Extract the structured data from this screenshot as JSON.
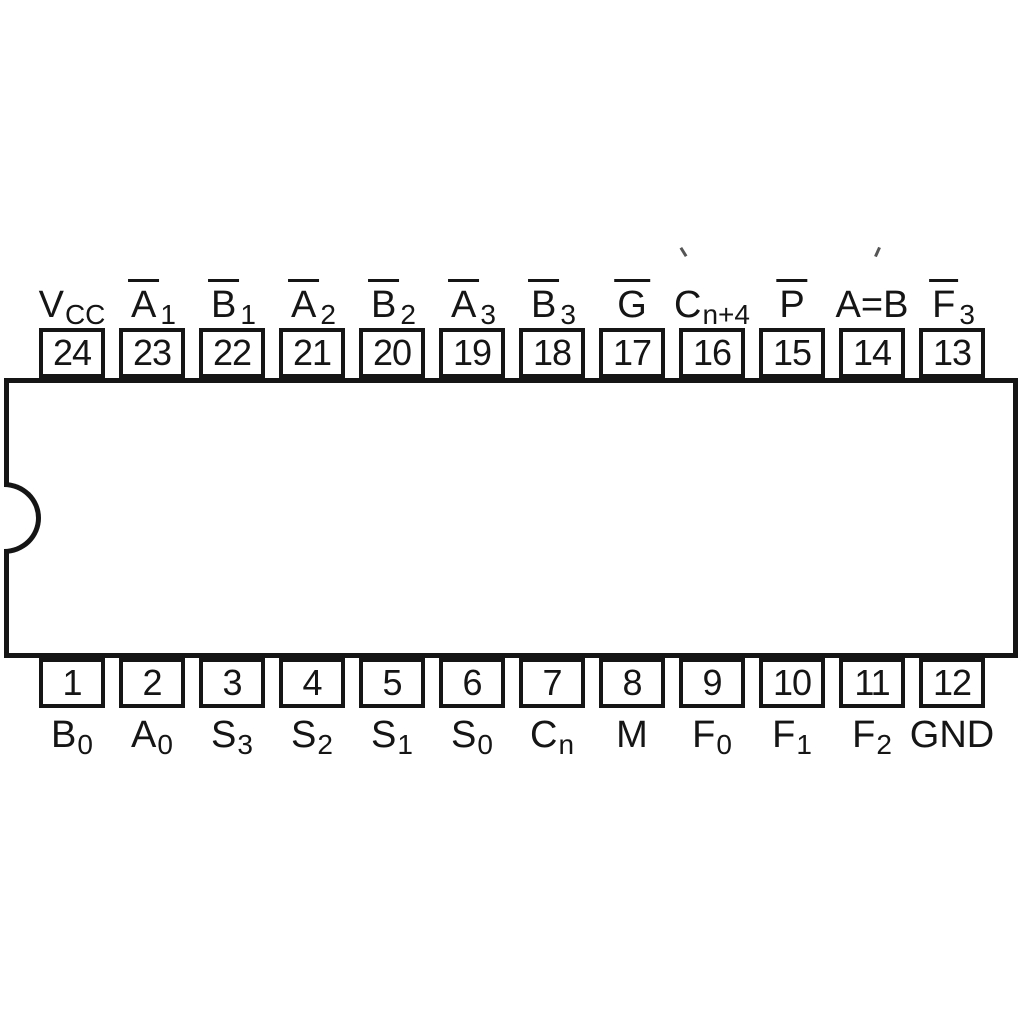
{
  "diagram": {
    "type": "ic-pinout-dip24",
    "ink_color": "#151515",
    "background_color": "#ffffff"
  },
  "pins": {
    "top": [
      {
        "number": "24",
        "base": "V",
        "sub": "CC",
        "bar": false
      },
      {
        "number": "23",
        "base": "A",
        "sub": "1",
        "bar": true
      },
      {
        "number": "22",
        "base": "B",
        "sub": "1",
        "bar": true
      },
      {
        "number": "21",
        "base": "A",
        "sub": "2",
        "bar": true
      },
      {
        "number": "20",
        "base": "B",
        "sub": "2",
        "bar": true
      },
      {
        "number": "19",
        "base": "A",
        "sub": "3",
        "bar": true
      },
      {
        "number": "18",
        "base": "B",
        "sub": "3",
        "bar": true
      },
      {
        "number": "17",
        "base": "G",
        "sub": "",
        "bar": true
      },
      {
        "number": "16",
        "base": "C",
        "sub": "n+4",
        "bar": false
      },
      {
        "number": "15",
        "base": "P",
        "sub": "",
        "bar": true
      },
      {
        "number": "14",
        "base": "A=B",
        "sub": "",
        "bar": false
      },
      {
        "number": "13",
        "base": "F",
        "sub": "3",
        "bar": true
      }
    ],
    "bottom": [
      {
        "number": "1",
        "base": "B",
        "sub": "0",
        "bar": false
      },
      {
        "number": "2",
        "base": "A",
        "sub": "0",
        "bar": false
      },
      {
        "number": "3",
        "base": "S",
        "sub": "3",
        "bar": false
      },
      {
        "number": "4",
        "base": "S",
        "sub": "2",
        "bar": false
      },
      {
        "number": "5",
        "base": "S",
        "sub": "1",
        "bar": false
      },
      {
        "number": "6",
        "base": "S",
        "sub": "0",
        "bar": false
      },
      {
        "number": "7",
        "base": "C",
        "sub": "n",
        "bar": false
      },
      {
        "number": "8",
        "base": "M",
        "sub": "",
        "bar": false
      },
      {
        "number": "9",
        "base": "F",
        "sub": "0",
        "bar": false
      },
      {
        "number": "10",
        "base": "F",
        "sub": "1",
        "bar": false
      },
      {
        "number": "11",
        "base": "F",
        "sub": "2",
        "bar": false
      },
      {
        "number": "12",
        "base": "GND",
        "sub": "",
        "bar": false
      }
    ]
  }
}
